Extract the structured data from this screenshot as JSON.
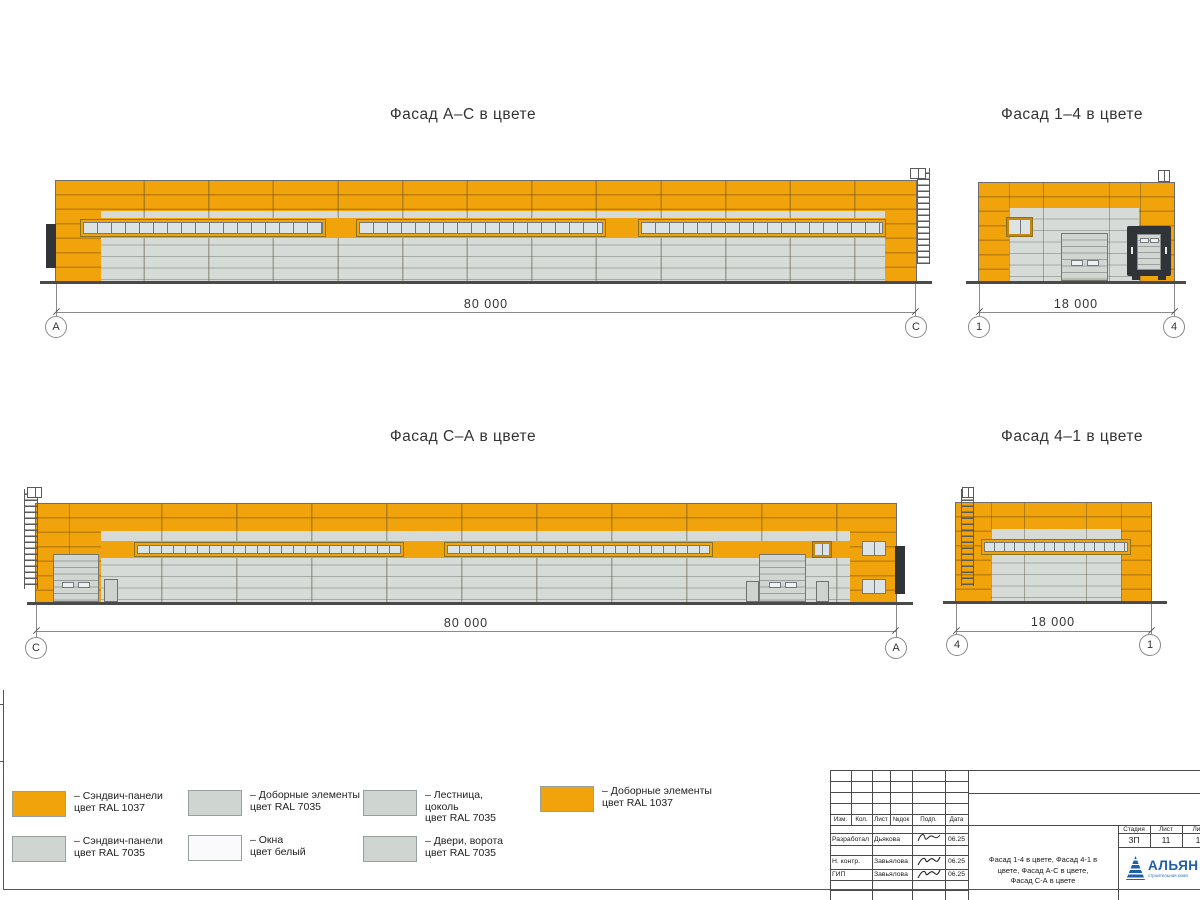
{
  "colors": {
    "orange": "#F0A30B",
    "orange-seam": "#C08009",
    "gray-panel": "#D7DBD7",
    "gray-seam": "#A6ABA6",
    "pane": "#DCE3E5",
    "pane-line": "#75797B",
    "door-gray": "#D2D6D2",
    "dock-dark": "#303438",
    "logo-blue": "#1E5FAC"
  },
  "facades": {
    "ac": {
      "title": "Фасад А–С в цвете",
      "dimension": "80 000",
      "marker_left": "А",
      "marker_right": "С"
    },
    "f14": {
      "title": "Фасад 1–4 в цвете",
      "dimension": "18 000",
      "marker_left": "1",
      "marker_right": "4"
    },
    "ca": {
      "title": "Фасад С–А в цвете",
      "dimension": "80 000",
      "marker_left": "С",
      "marker_right": "А"
    },
    "f41": {
      "title": "Фасад 4–1 в цвете",
      "dimension": "18 000",
      "marker_left": "4",
      "marker_right": "1"
    }
  },
  "legend": {
    "items": [
      {
        "swatch": "orange",
        "label": "– Сэндвич-панели\nцвет RAL 1037"
      },
      {
        "swatch": "gray",
        "label": "– Сэндвич-панели\nцвет RAL 7035"
      },
      {
        "swatch": "gray",
        "label": "– Доборные элементы\nцвет RAL 7035"
      },
      {
        "swatch": "white",
        "label": "– Окна\nцвет белый"
      },
      {
        "swatch": "gray",
        "label": "– Лестница,\nцоколь\nцвет RAL 7035"
      },
      {
        "swatch": "gray",
        "label": "– Двери, ворота\nцвет RAL 7035"
      },
      {
        "swatch": "orange",
        "label": "– Доборные элементы\nцвет RAL 1037"
      }
    ]
  },
  "stamp": {
    "headers": {
      "izm": "Изм.",
      "kol": "Кол.",
      "list": "Лист",
      "ndok": "№док",
      "podp": "Подп.",
      "data": "Дата"
    },
    "rows": [
      {
        "role": "Разработал",
        "name": "Дьякова",
        "date": "06.25"
      },
      {
        "role": "Н. контр.",
        "name": "Завьялова",
        "date": "06.25"
      },
      {
        "role": "ГИП",
        "name": "Завьялова",
        "date": "06.25"
      }
    ],
    "doc_title": "Фасад 1-4 в цвете, Фасад 4-1 в\nцвете, Фасад А-С в цвете,\nФасад С-А в цвете",
    "stage_label": "Стадия",
    "sheet_label": "Лист",
    "sheets_label": "Лис",
    "stage": "ЗП",
    "sheet": "11",
    "sheets": "1",
    "logo_text": "АЛЬЯН",
    "logo_sub": "строительная комп"
  }
}
